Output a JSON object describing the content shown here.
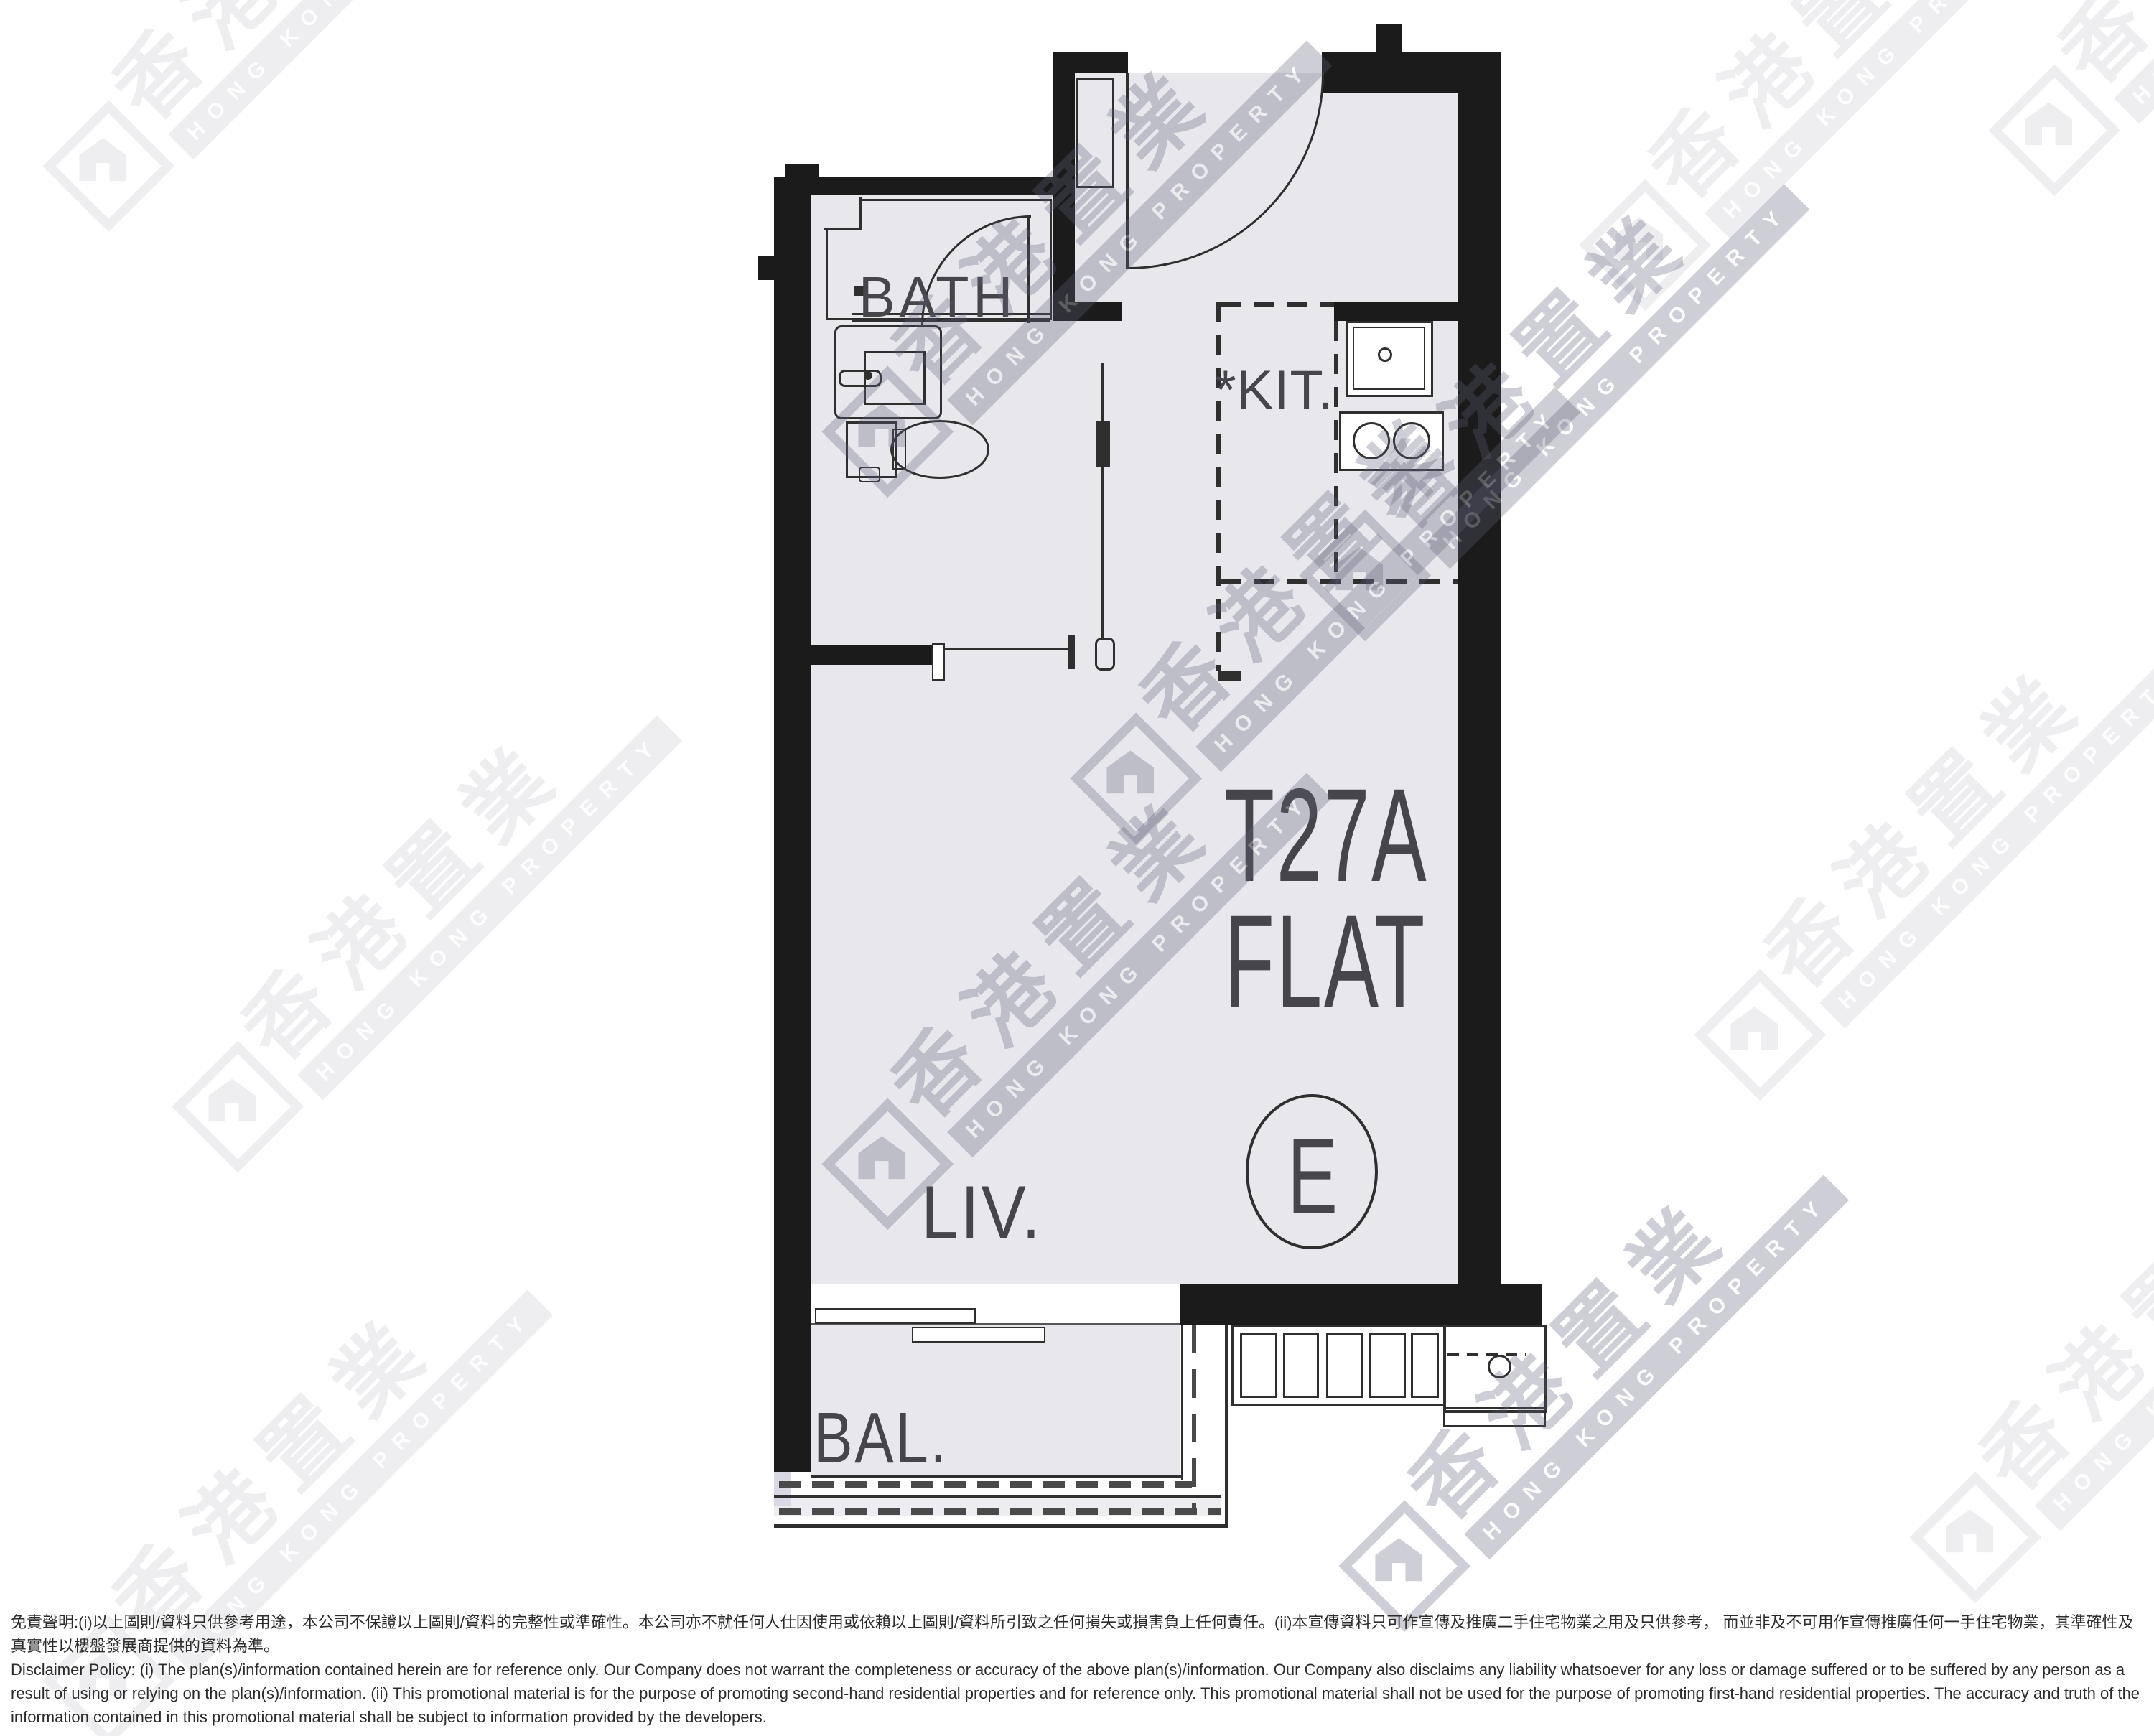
{
  "plan": {
    "unit_label": "T27A",
    "flat_label": "FLAT",
    "flat_letter": "E",
    "rooms": {
      "bath": "BATH",
      "kitchen": "*KIT.",
      "living": "LIV.",
      "balcony": "BAL."
    }
  },
  "watermark": {
    "brand": "香港置業",
    "brand_en": "HONG KONG PROPERTY"
  },
  "disclaimer": {
    "zh": "免責聲明:(i)以上圖則/資料只供參考用途，本公司不保證以上圖則/資料的完整性或準確性。本公司亦不就任何人仕因使用或依賴以上圖則/資料所引致之任何損失或損害負上任何責任。(ii)本宣傳資料只可作宣傳及推廣二手住宅物業之用及只供參考， 而並非及不可用作宣傳推廣任何一手住宅物業，其準確性及真實性以樓盤發展商提供的資料為準。",
    "en": "Disclaimer Policy: (i) The plan(s)/information contained herein are for reference only. Our Company does not warrant the completeness or accuracy of the above plan(s)/information. Our Company also disclaims any liability whatsoever for any loss or damage suffered or to be suffered by any person as a result of using or relying on the plan(s)/information. (ii) This promotional material is for the purpose of promoting second-hand residential properties and for reference only. This promotional material shall not be used for the purpose of promoting first-hand residential properties. The accuracy and truth of the information contained in this promotional material shall be subject to information provided by the developers."
  },
  "colors": {
    "wall": "#1b1b1b",
    "floor": "#e8e8ec",
    "line": "#2f2f2f",
    "watermark": "#60607a"
  }
}
